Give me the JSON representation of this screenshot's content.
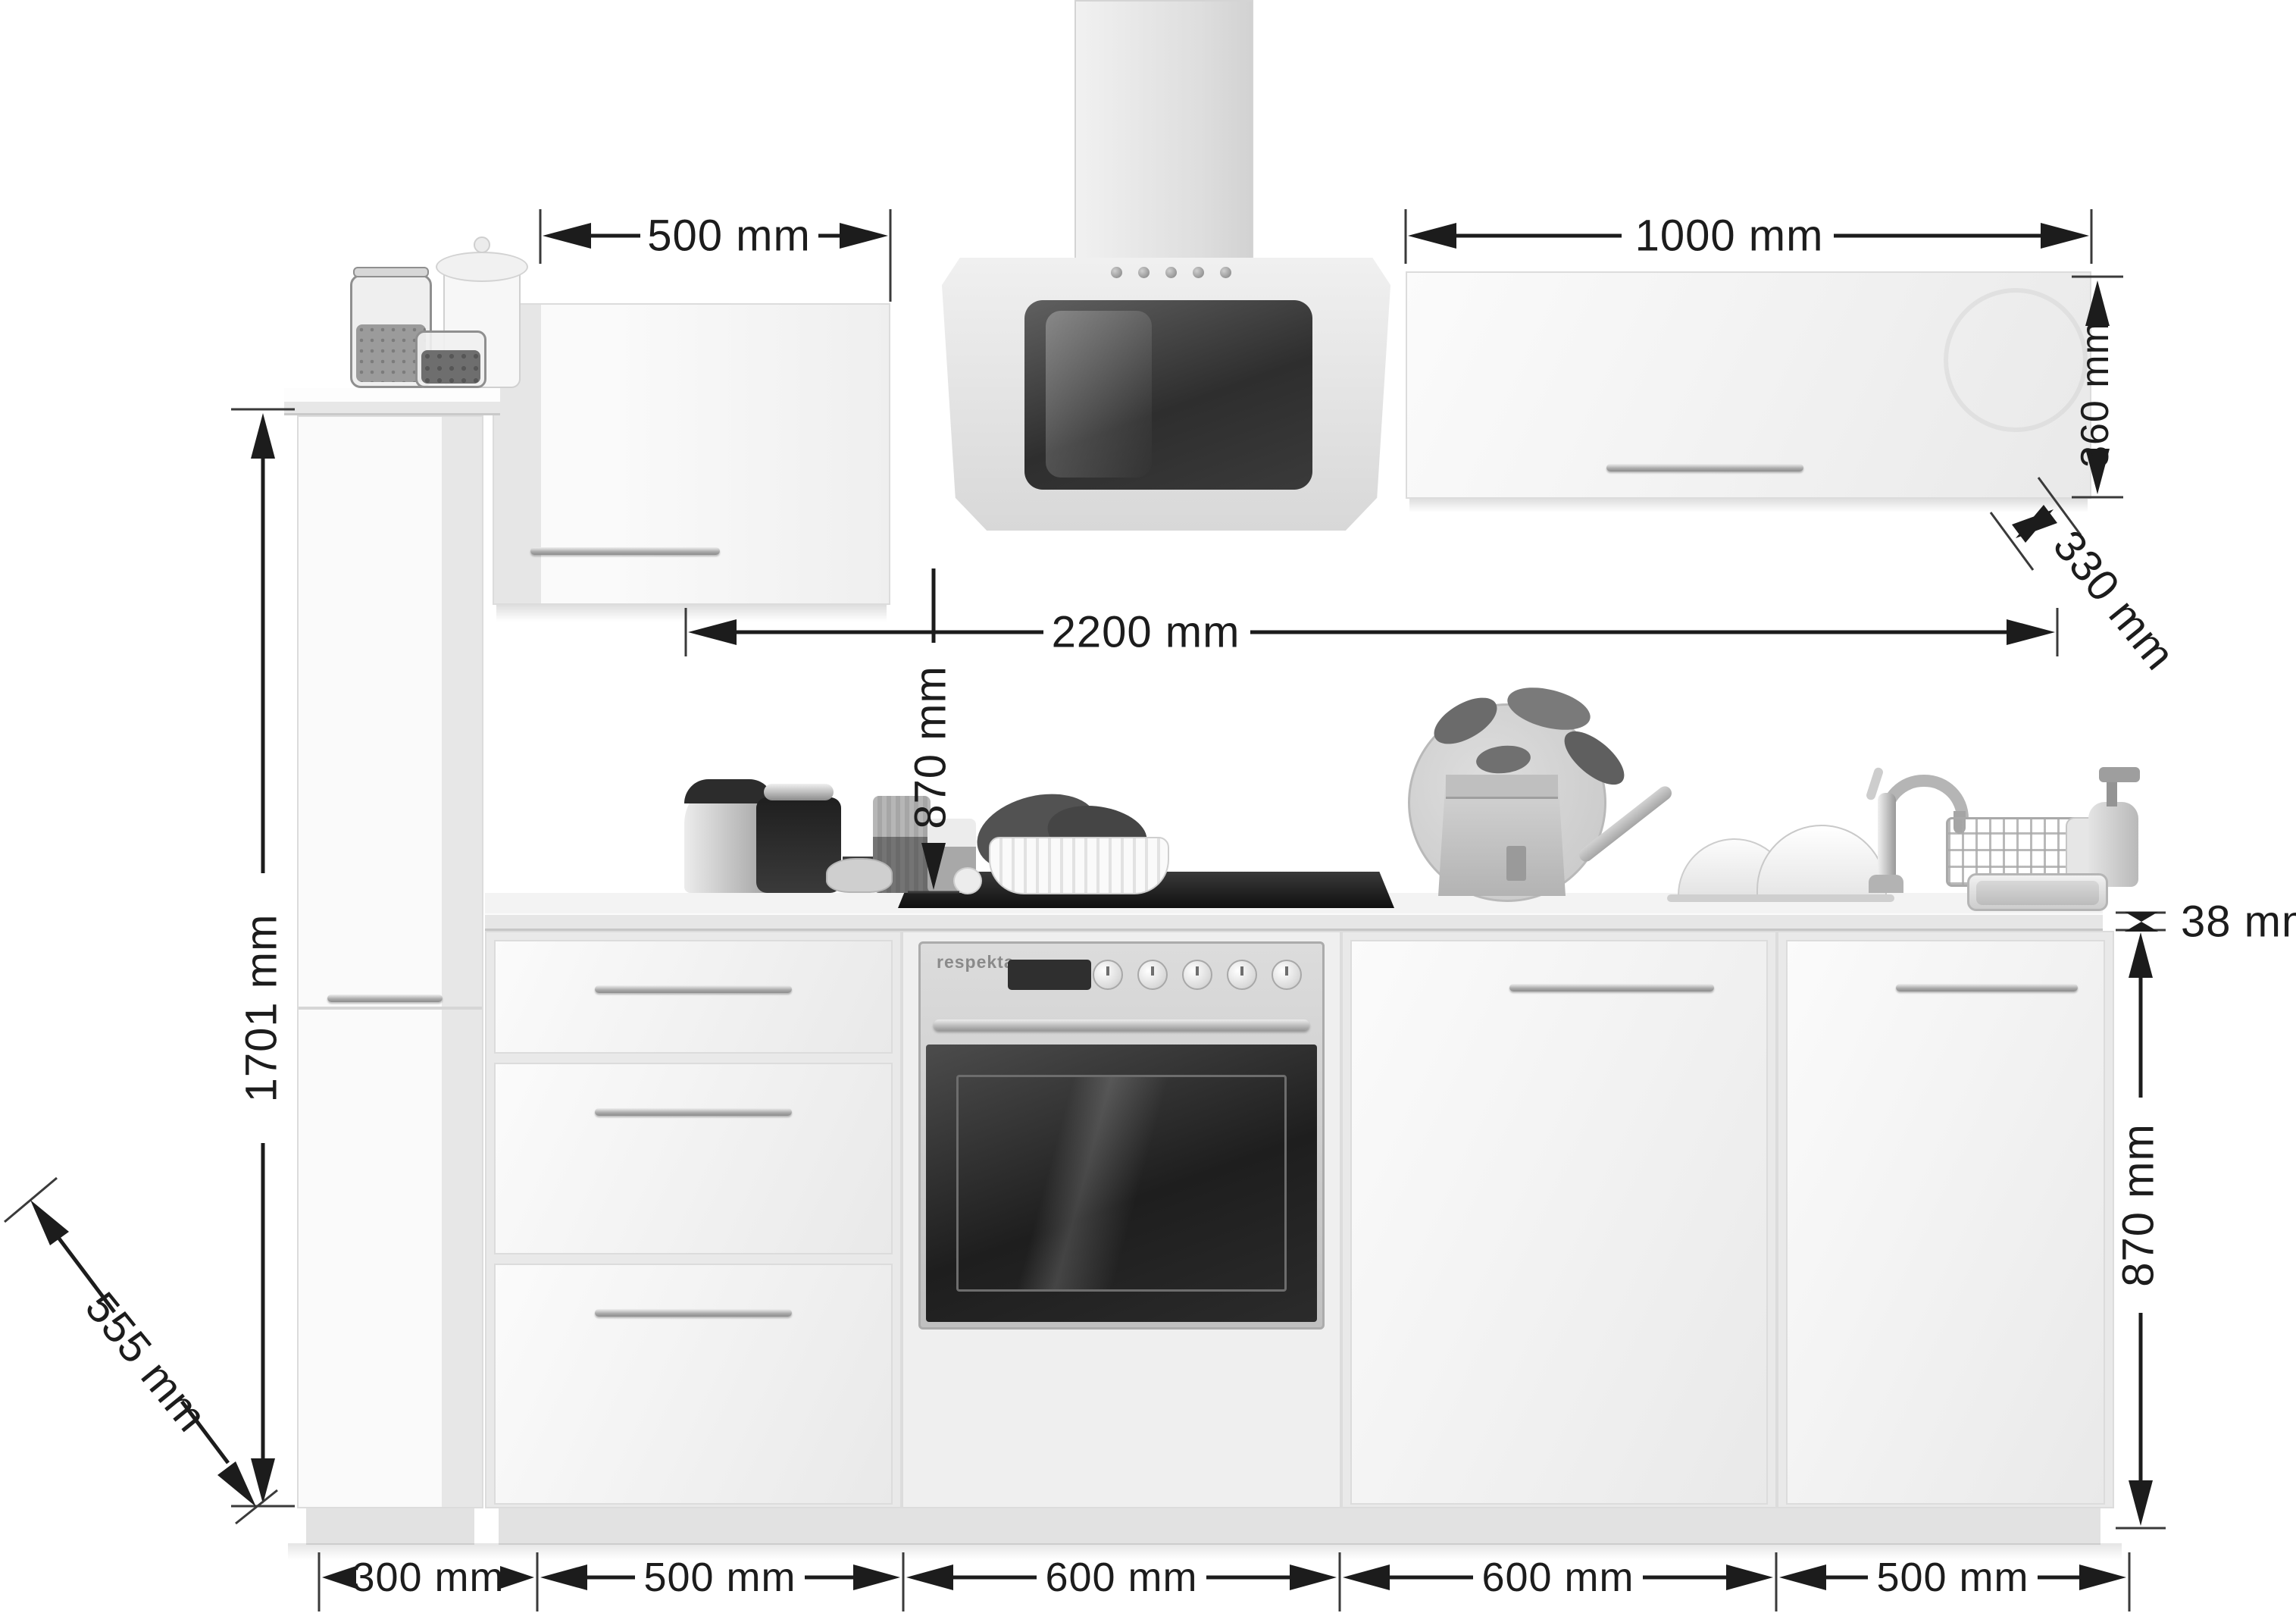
{
  "colors": {
    "background": "#ffffff",
    "dimension_ink": "#1c1c1c",
    "cabinet_light": "#f4f4f4",
    "cabinet_border": "#dcdcdc",
    "steel": "#c4c4c4",
    "dark_glass": "#232323"
  },
  "oven": {
    "brand": "respekta"
  },
  "dimensions": {
    "wall_cabinet_left_width": "500 mm",
    "wall_cabinet_right_width": "1000 mm",
    "wall_cabinet_right_height": "360 mm",
    "wall_cabinet_right_depth": "330 mm",
    "run_width": "2200 mm",
    "wall_cabinet_to_worktop": "870 mm",
    "worktop_thickness": "38 mm",
    "base_cabinet_height": "870 mm",
    "tall_cabinet_height": "1701 mm",
    "worktop_depth": "555 mm",
    "base_segments": [
      "300 mm",
      "500 mm",
      "600 mm",
      "600 mm",
      "500 mm"
    ]
  }
}
